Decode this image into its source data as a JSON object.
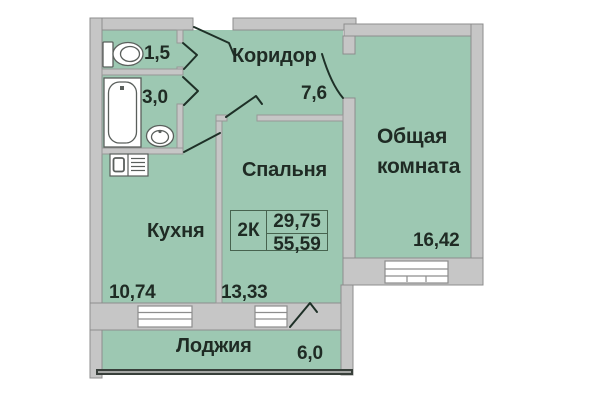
{
  "unit": {
    "type": "2К",
    "area_upper": "29,75",
    "area_lower": "55,59"
  },
  "rooms": {
    "corridor": {
      "label": "Коридор",
      "area": "7,6"
    },
    "wc": {
      "area": "1,5"
    },
    "bathroom": {
      "area": "3,0"
    },
    "kitchen": {
      "label": "Кухня",
      "area": "10,74"
    },
    "bedroom": {
      "label": "Спальня",
      "area": "13,33"
    },
    "living_room": {
      "label": "Общая комната",
      "area": "16,42"
    },
    "loggia": {
      "label": "Лоджия",
      "area": "6,0"
    }
  },
  "colors": {
    "background": "#ffffff",
    "room_fill": "#9dc8b2",
    "wall_fill": "#c6c6c6",
    "wall_border": "#8d8d8d",
    "door_line": "#1e3027",
    "text": "#1f2b24",
    "badge_border": "#47634f",
    "glazing": "#383f3a"
  }
}
